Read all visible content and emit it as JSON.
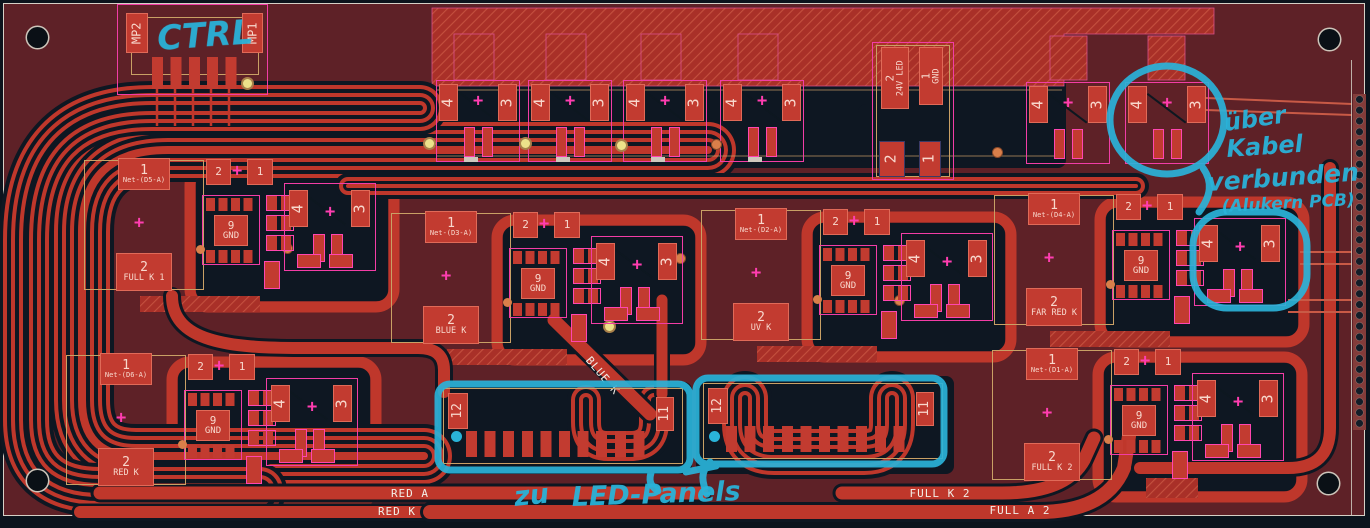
{
  "colors": {
    "board": "#5e2127",
    "copper": "#bf372b",
    "dark_plane": "#0e1722",
    "pink_outline": "#f23da6",
    "gold_courtyard": "#c9a065",
    "pad_fill": "#c23b30",
    "annotation_cyan": "#2ab3d9"
  },
  "ctrl_header": {
    "mp_left": "MP2",
    "mp_right": "MP1"
  },
  "power": {
    "pin2": "2",
    "net2": "24V LED",
    "pin1": "1",
    "net1": "GND",
    "aux_left": "2",
    "aux_right": "1"
  },
  "fet": {
    "drain": "4",
    "source": "3"
  },
  "clusters": [
    {
      "pin1": "1",
      "net1": "Net-(D5-A)",
      "pin2": "2",
      "net2": "FULL K 1",
      "top_a": "2",
      "top_b": "1",
      "ic_pin": "9",
      "ic_net": "GND"
    },
    {
      "pin1": "1",
      "net1": "Net-(D3-A)",
      "pin2": "2",
      "net2": "BLUE K",
      "top_a": "2",
      "top_b": "1",
      "ic_pin": "9",
      "ic_net": "GND"
    },
    {
      "pin1": "1",
      "net1": "Net-(D2-A)",
      "pin2": "2",
      "net2": "UV K",
      "top_a": "2",
      "top_b": "1",
      "ic_pin": "9",
      "ic_net": "GND"
    },
    {
      "pin1": "1",
      "net1": "Net-(D4-A)",
      "pin2": "2",
      "net2": "FAR RED K",
      "top_a": "2",
      "top_b": "1",
      "ic_pin": "9",
      "ic_net": "GND"
    },
    {
      "pin1": "1",
      "net1": "Net-(D6-A)",
      "pin2": "2",
      "net2": "RED K",
      "top_a": "2",
      "top_b": "1",
      "ic_pin": "9",
      "ic_net": "GND"
    },
    {
      "pin1": "1",
      "net1": "Net-(D1-A)",
      "pin2": "2",
      "net2": "FULL K 2",
      "top_a": "2",
      "top_b": "1",
      "ic_pin": "9",
      "ic_net": "GND"
    }
  ],
  "connectors": [
    {
      "left": "12",
      "right": "11"
    },
    {
      "left": "12",
      "right": "11"
    }
  ],
  "trace_labels": {
    "blue_k": "BLUE K",
    "red_a": "RED A",
    "red_k": "RED K",
    "full_k2": "FULL K 2",
    "full_a2": "FULL A 2"
  },
  "handwriting": {
    "ctrl": "CTRL",
    "line1": "über",
    "line2": "Kabel",
    "line3": "verbunden",
    "line4": "(Alukern PCB)",
    "zu": "zu",
    "panels": "LED-Panels"
  }
}
